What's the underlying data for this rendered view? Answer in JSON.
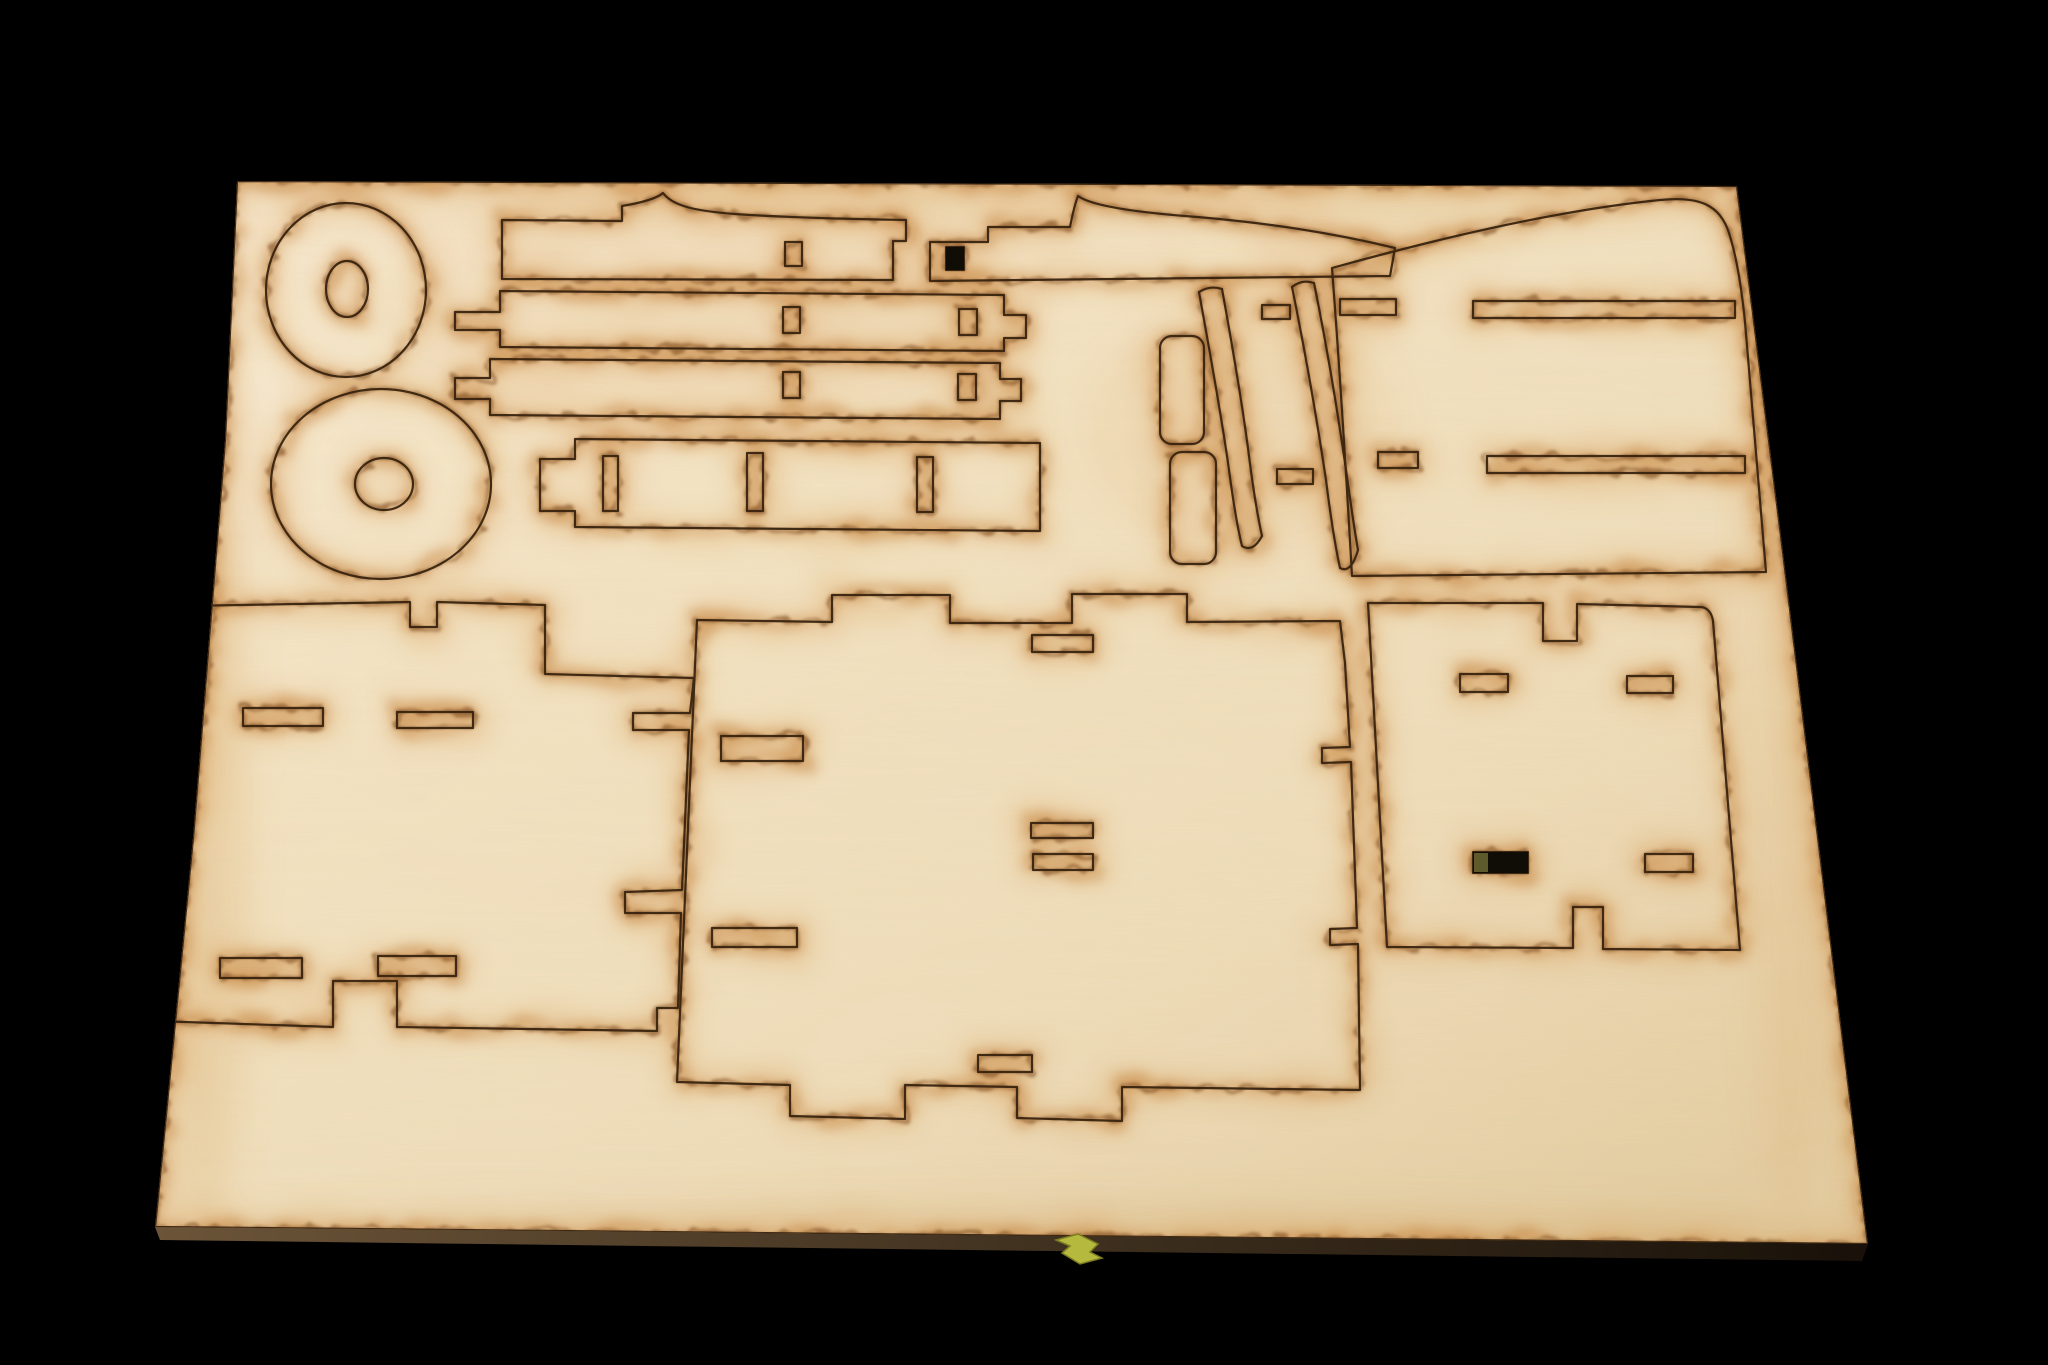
{
  "scene": {
    "description": "Photograph of a laser-cut plywood sheet with model-kit parts outlined by scorched cut lines, on a black background",
    "colors": {
      "background": "#000000",
      "wood_light": "#f8edd6",
      "wood_mid": "#f2e2c2",
      "wood_deep": "#eedcba",
      "wood_shadow": "#e4cda2",
      "grain": "#b8915a",
      "scorch_halo": "#d89a52",
      "scorch_wide": "#c07a33",
      "scorch_tight": "#7d4a1a",
      "cut_line": "#38230f",
      "edge_side_light": "#6b5438",
      "edge_side_dark": "#191109",
      "slot_hole": "#100c06",
      "slot_hole_olive": "#5e5a2b",
      "tie_yellow": "#b5b93e",
      "tie_outline": "#7c7c22"
    },
    "pieces": [
      {
        "name": "wheel-disc-top",
        "type": "disc with hub hole"
      },
      {
        "name": "wheel-disc-bottom",
        "type": "disc with hub hole"
      },
      {
        "name": "spiked-slat",
        "slots": 2
      },
      {
        "name": "spiked-rail",
        "slots": 1
      },
      {
        "name": "slat-row-2",
        "slots": 2
      },
      {
        "name": "slat-row-3",
        "slots": 2
      },
      {
        "name": "wide-slat",
        "slots": 3
      },
      {
        "name": "pill-bracket-upper",
        "slots": 0
      },
      {
        "name": "pill-bracket-lower",
        "slots": 0
      },
      {
        "name": "curved-blade-left",
        "slots": 0
      },
      {
        "name": "curved-blade-right",
        "slots": 0
      },
      {
        "name": "top-right-panel",
        "slots": 4
      },
      {
        "name": "bottom-left-panel",
        "slots": 4
      },
      {
        "name": "bottom-center-panel",
        "slots": 6
      },
      {
        "name": "bottom-right-panel",
        "slots": 4
      }
    ]
  }
}
